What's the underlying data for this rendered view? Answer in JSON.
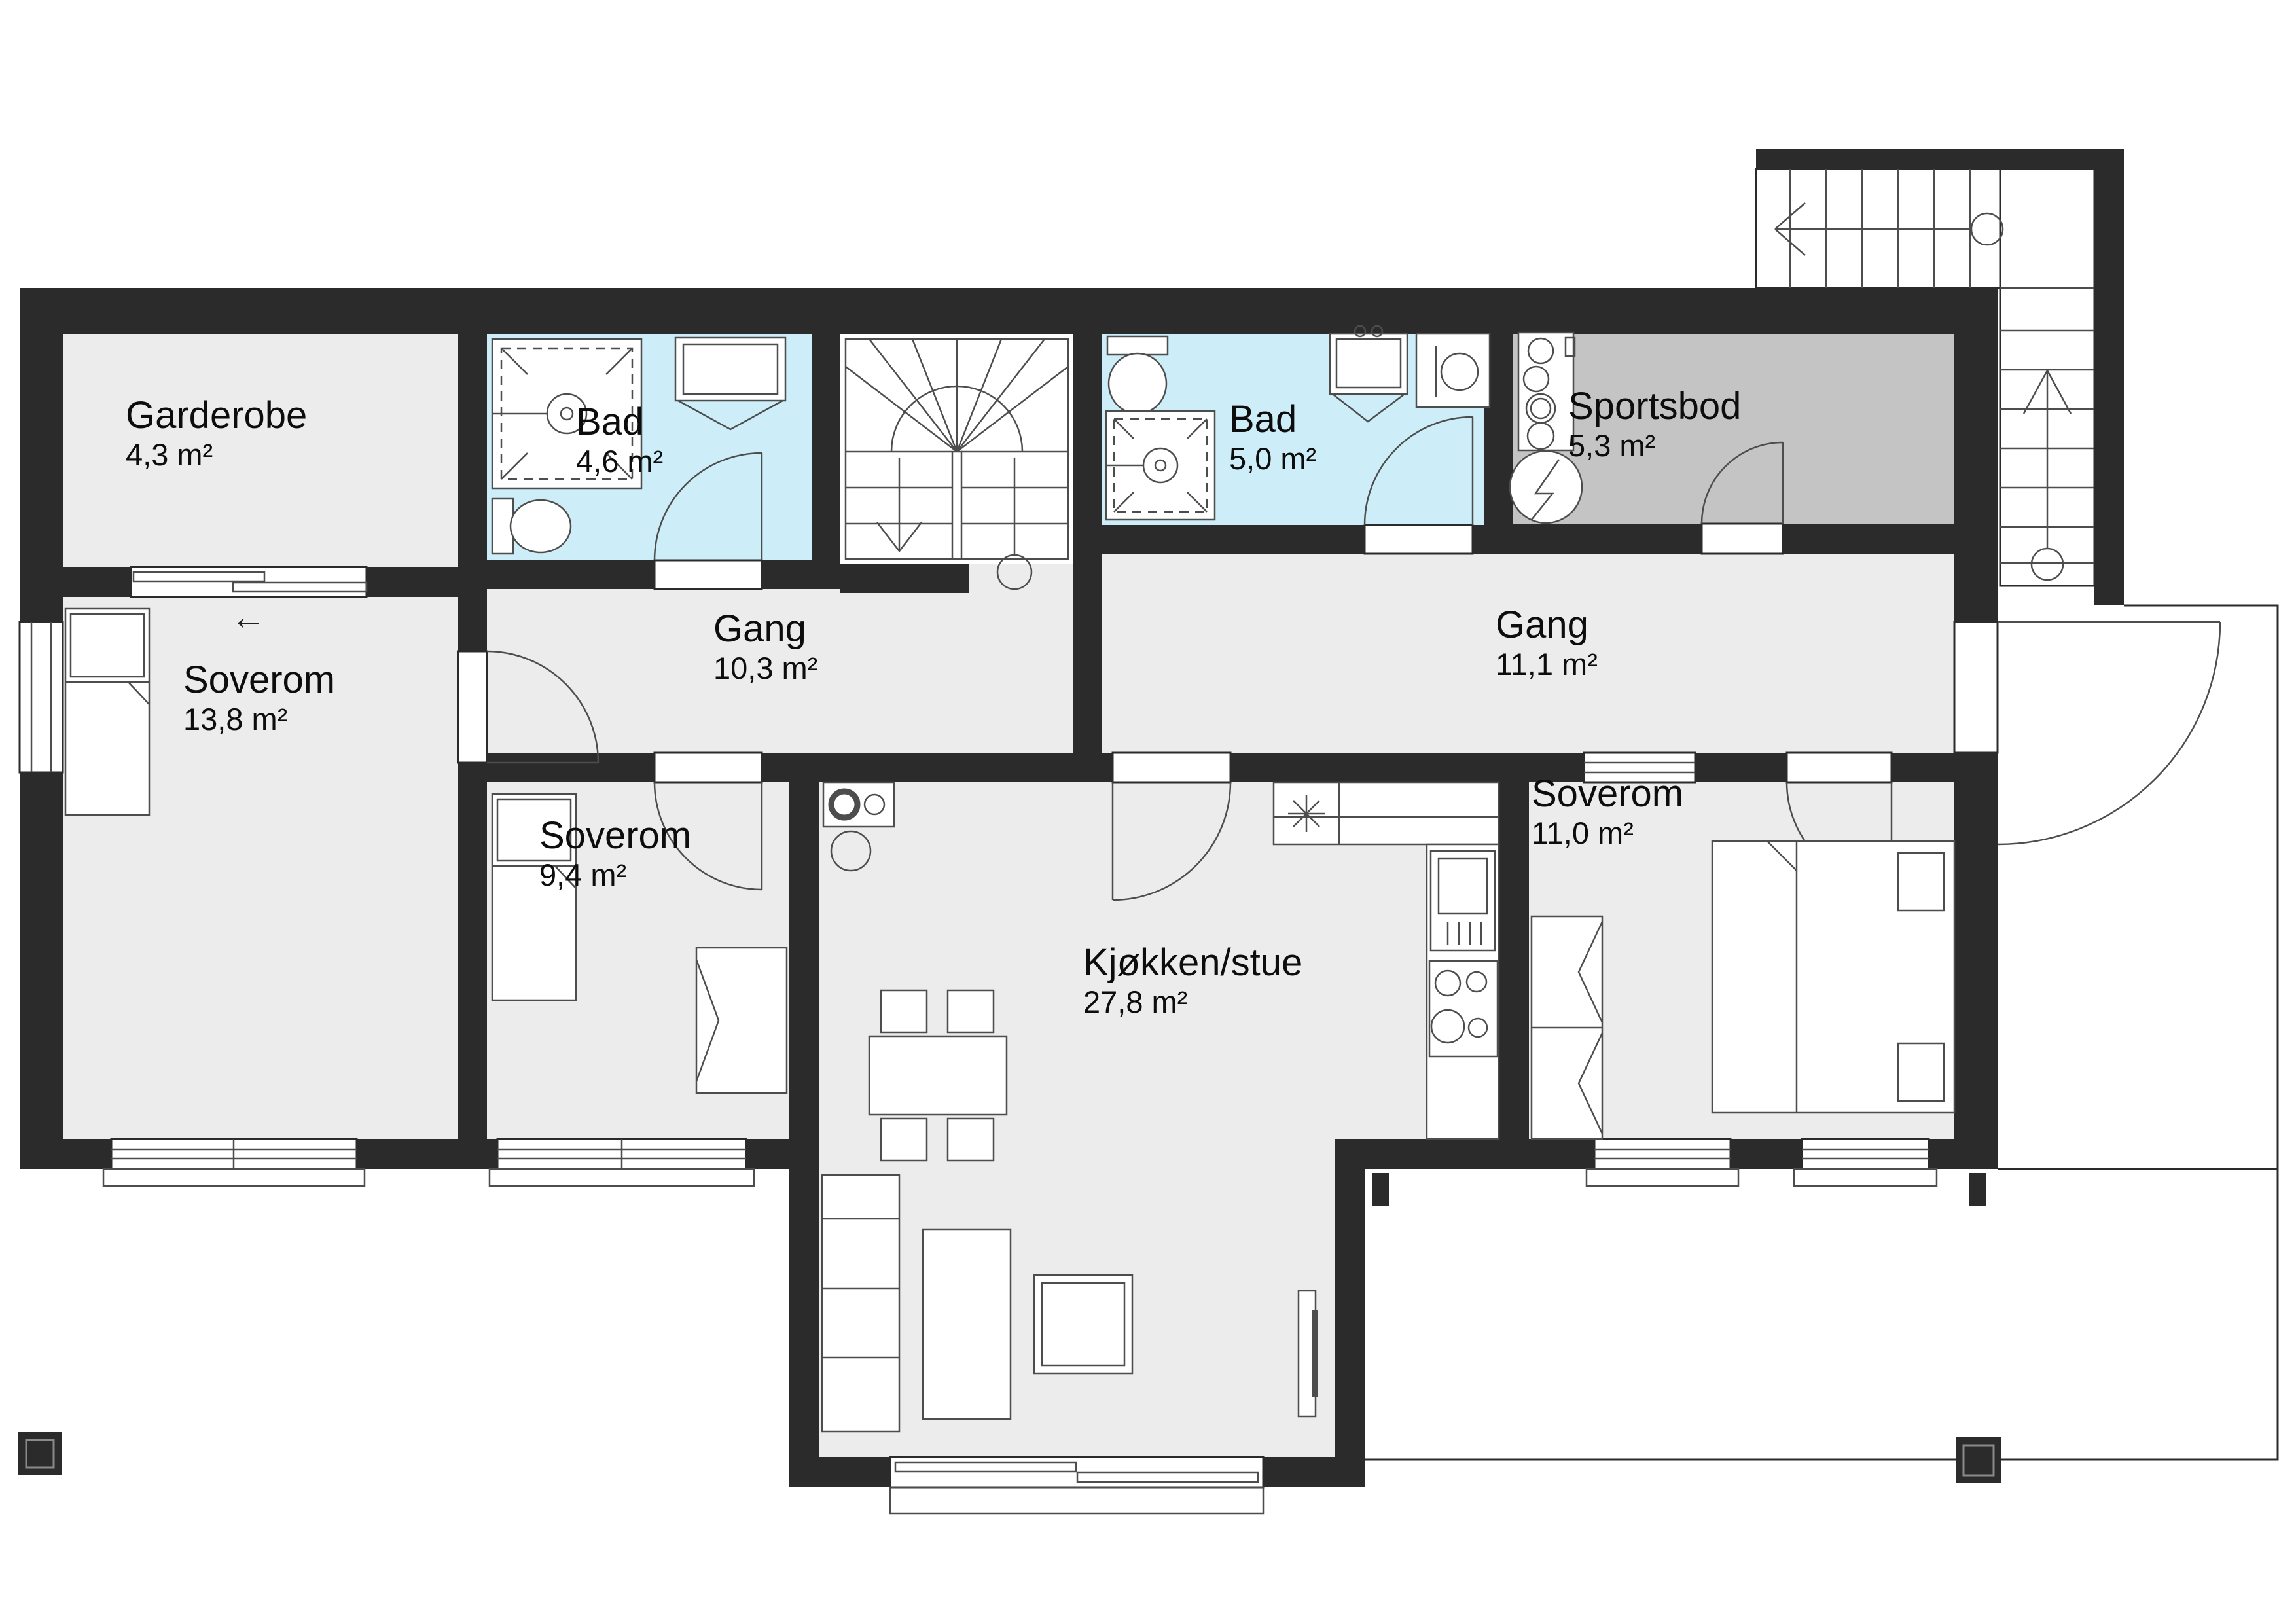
{
  "plan": {
    "type": "floor-plan",
    "language": "Norwegian",
    "colors": {
      "wall": "#2b2b2b",
      "floor": "#ececec",
      "bath": "#cdeef8",
      "storage": "#c4c4c4",
      "line": "#4d4d4d"
    },
    "rooms": [
      {
        "id": "garderobe",
        "name": "Garderobe",
        "area": "4,3 m²",
        "label_x": 192,
        "label_y": 602
      },
      {
        "id": "bad-1",
        "name": "Bad",
        "area": "4,6 m²",
        "label_x": 880,
        "label_y": 612
      },
      {
        "id": "bad-2",
        "name": "Bad",
        "area": "5,0 m²",
        "label_x": 1878,
        "label_y": 608
      },
      {
        "id": "sportsbod",
        "name": "Sportsbod",
        "area": "5,3 m²",
        "label_x": 2396,
        "label_y": 588
      },
      {
        "id": "gang-1",
        "name": "Gang",
        "area": "10,3 m²",
        "label_x": 1090,
        "label_y": 928
      },
      {
        "id": "gang-2",
        "name": "Gang",
        "area": "11,1 m²",
        "label_x": 2285,
        "label_y": 922
      },
      {
        "id": "soverom-1",
        "name": "Soverom",
        "area": "13,8 m²",
        "label_x": 280,
        "label_y": 1006
      },
      {
        "id": "soverom-2",
        "name": "Soverom",
        "area": "9,4 m²",
        "label_x": 824,
        "label_y": 1244
      },
      {
        "id": "soverom-3",
        "name": "Soverom",
        "area": "11,0 m²",
        "label_x": 2340,
        "label_y": 1180
      },
      {
        "id": "kjokken-stue",
        "name": "Kjøkken/stue",
        "area": "27,8 m²",
        "label_x": 1655,
        "label_y": 1438
      }
    ],
    "symbols": {
      "entry_arrow": "←"
    }
  }
}
